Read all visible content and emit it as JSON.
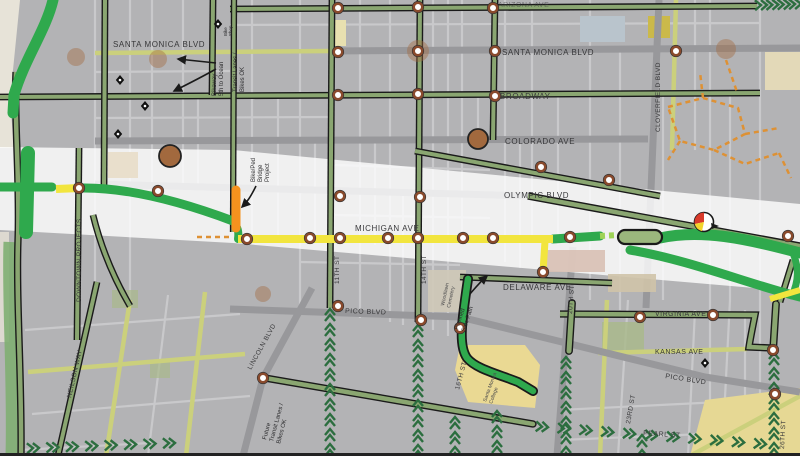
{
  "map": {
    "title": "Santa Monica bikeway projects map",
    "streets": {
      "horizontal": {
        "arizona": "ARIZONA AVE",
        "santa_monica": "SANTA MONICA BLVD",
        "broadway": "BROADWAY",
        "colorado": "COLORADO AVE",
        "olympic": "OLYMPIC BLVD",
        "michigan": "MICHIGAN AVE",
        "delaware": "DELAWARE AVE",
        "pico": "PICO BLVD",
        "virginia": "VIRGINIA AVE",
        "kansas": "KANSAS AVE",
        "pearl": "PEARL ST"
      },
      "vertical": {
        "neilson": "NEILSON WAY",
        "downtown": "DOWNTOWN PROJECTS",
        "lincoln": "LINCOLN BLVD",
        "st11": "11TH ST",
        "st14": "14TH ST",
        "st16": "16TH ST",
        "st20": "20TH ST",
        "cloverfield": "CLOVERFIELD BLVD",
        "st23": "23RD ST",
        "st26": "26TH ST"
      }
    },
    "annotations": {
      "transit_lanes": {
        "l1": "Transit Lanes /",
        "l2": "Bikes OK"
      },
      "bikeway_ocean": {
        "l1": "Bikeway",
        "l2": "5th to Ocean"
      },
      "bridge_project": {
        "l1": "Bike/Ped",
        "l2": "Bridge",
        "l3": "Project"
      },
      "future_transit": {
        "l1": "Future",
        "l2": "Transit Lanes /",
        "l3": "Bikes OK"
      },
      "planned_side_path": {
        "l1": "Planned",
        "l2": "Side Path"
      },
      "woodlawn": {
        "l1": "Woodlawn",
        "l2": "Cemetery"
      },
      "smc": {
        "l1": "Santa Monica",
        "l2": "College"
      },
      "bike_shop": {
        "l1": "Bike",
        "l2": "Shop"
      }
    },
    "icons": {
      "expo_station": "brown-circle",
      "crossing_marker": "white-ring-circle",
      "bike_shop": "black-diamond-dot",
      "sharrow": "double-chevron",
      "signal": "red-yellow-pie"
    },
    "colors": {
      "bright_green": "#2fa94d",
      "light_green": "#9ed356",
      "olive_route": "#8aa671",
      "bike_lane": "#cbd07c",
      "route_yellow": "#f2e53e",
      "project_orange": "#f5921e",
      "station_brown": "#a2693e",
      "chevron_green": "#2c6e3f",
      "dashed_orange": "#de9134",
      "arterial_gray": "#98989b",
      "minor_street": "#c9c9cb",
      "block_gray": "#b3b3b5",
      "corridor_white": "#ffffff"
    }
  }
}
